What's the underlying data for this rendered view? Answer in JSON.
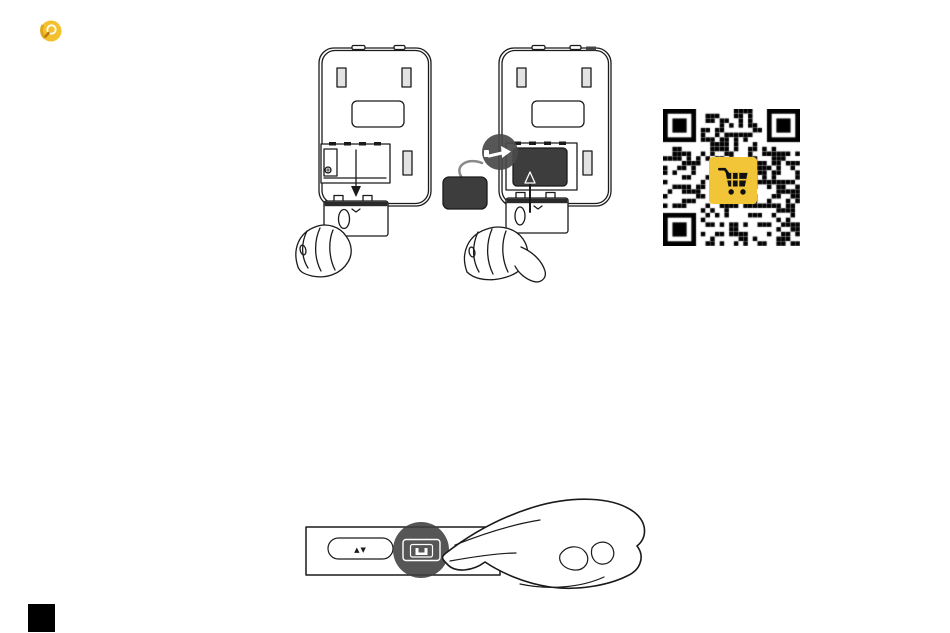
{
  "page": {
    "background": "#ffffff"
  },
  "logo": {
    "icon": "magnifier-logo",
    "primary_color": "#f4c12e",
    "ring_color": "#e2a517"
  },
  "illustrations": {
    "step1": {
      "name": "remove-battery-pack-illustration",
      "arrow": "down"
    },
    "step2": {
      "name": "connect-battery-pack-illustration",
      "arrow": "up",
      "plug_color": "#3d3d3d",
      "callout_color": "#4a4a4a"
    },
    "press": {
      "name": "press-battery-button-illustration",
      "updown_label": "▲▼",
      "highlight_color": "#3f3f3f"
    }
  },
  "qr": {
    "icon": "shopping-cart",
    "modules": 29,
    "dark": "#000000",
    "light": "#ffffff",
    "center_bg": "#f2c437",
    "cart_color": "#111111"
  },
  "marker": {
    "color": "#000000"
  }
}
